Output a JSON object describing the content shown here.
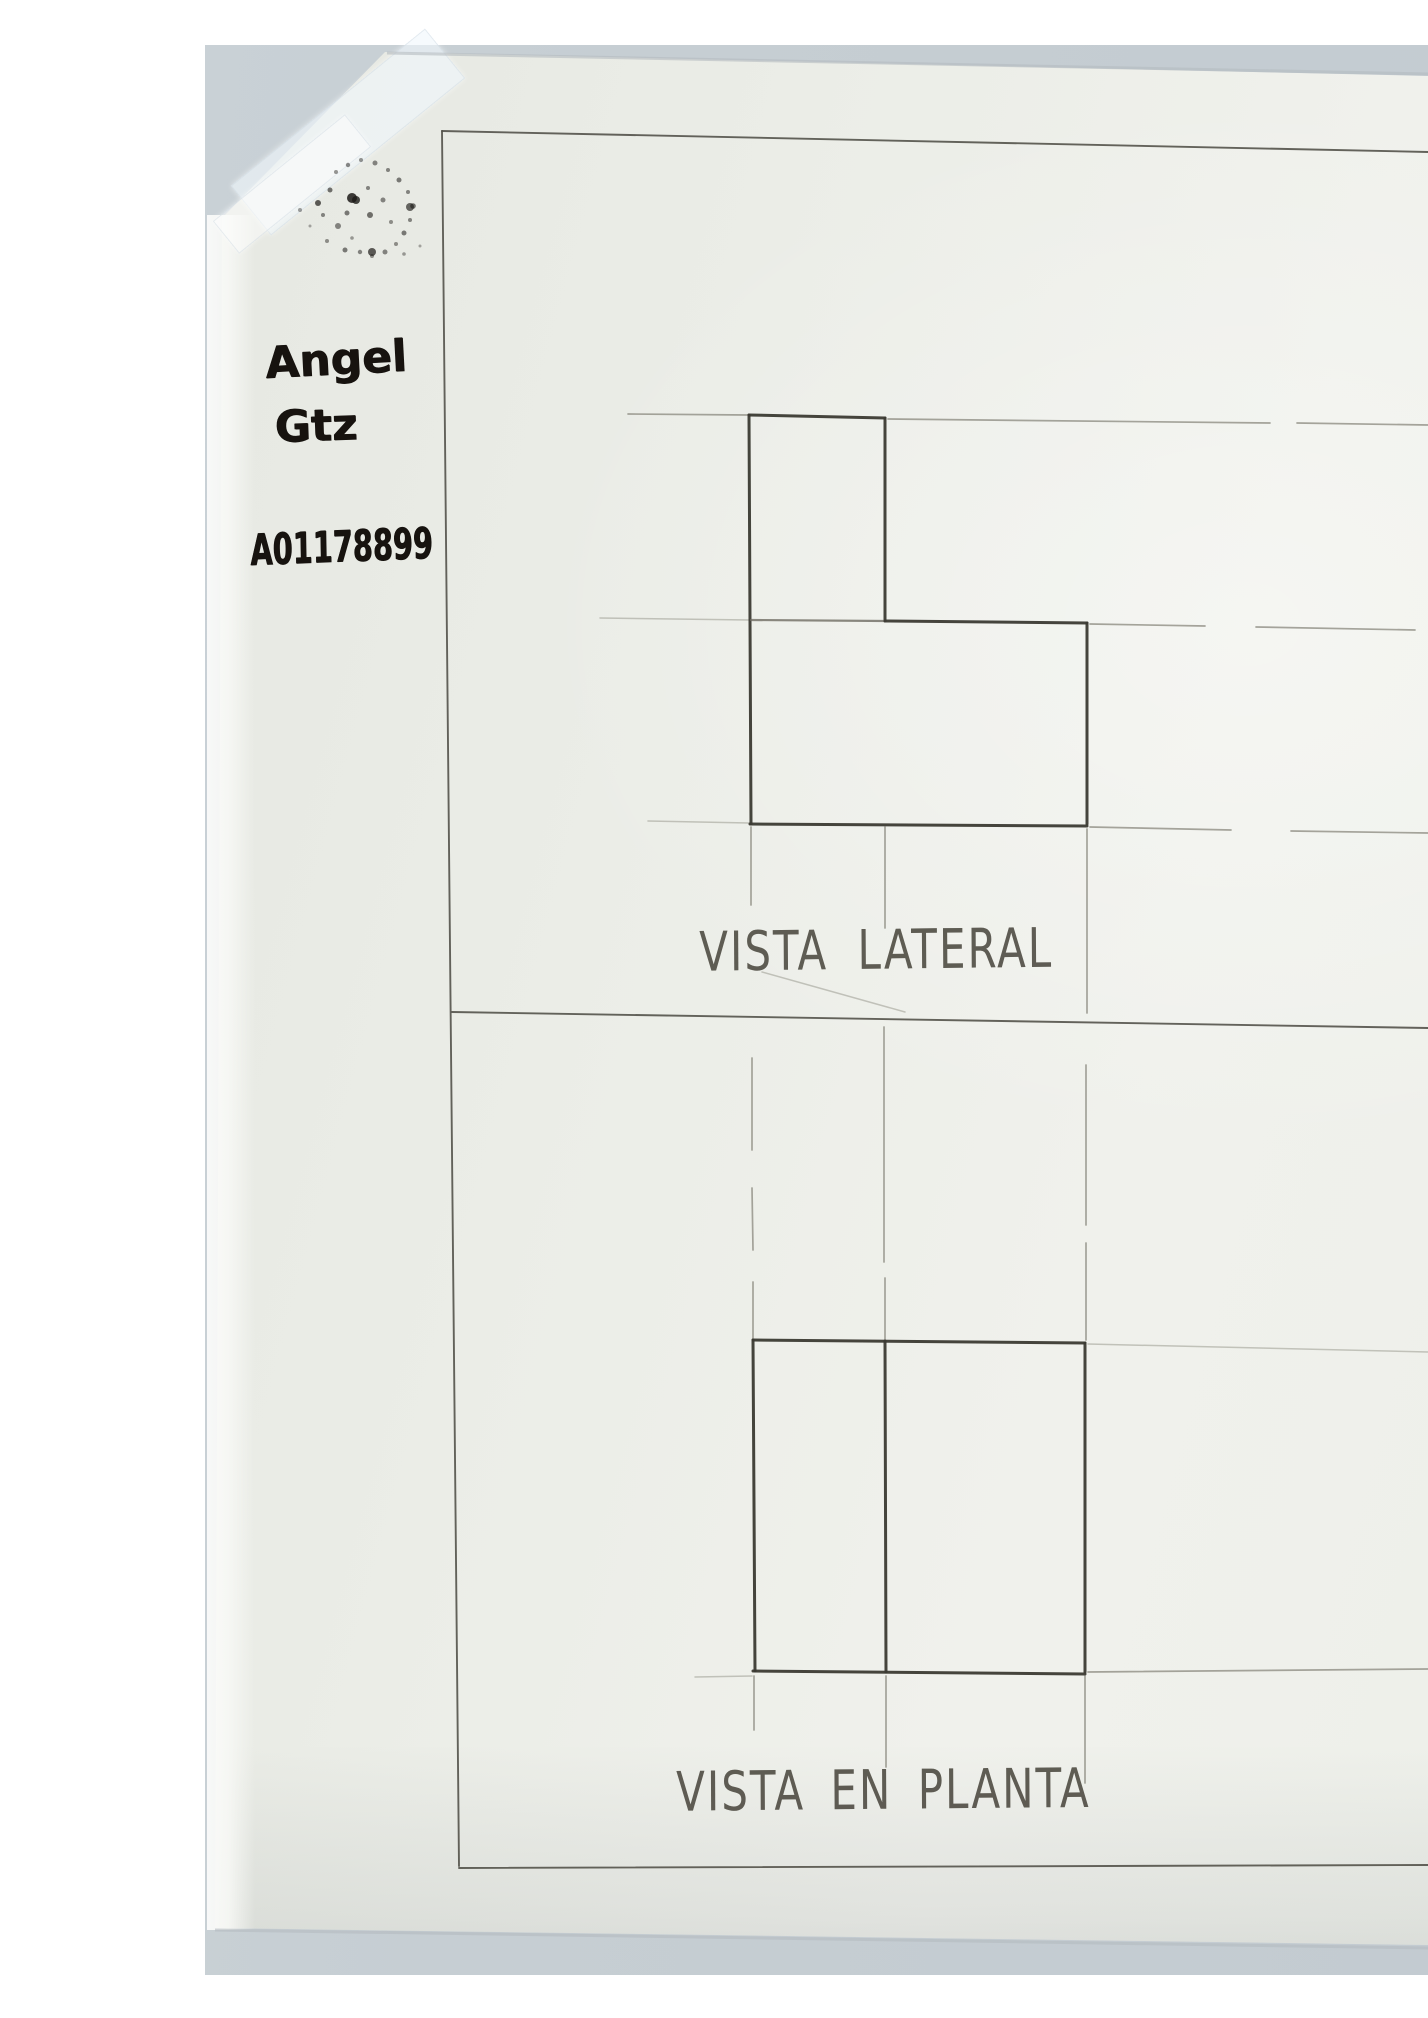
{
  "view_labels": {
    "side": "VISTA LATERAL",
    "plan": "VISTA EN PLANTA"
  },
  "handwriting": {
    "first_name": "Angel",
    "last_name": "Gtz",
    "student_id": "A01178899"
  },
  "colors": {
    "scan_margin": "#ffffff",
    "table_surface": "#c6ced3",
    "paper": "#edefe9",
    "pencil_dark": "#3b3a33",
    "pencil_faint": "#908f84",
    "marker_ink": "#17130f"
  }
}
